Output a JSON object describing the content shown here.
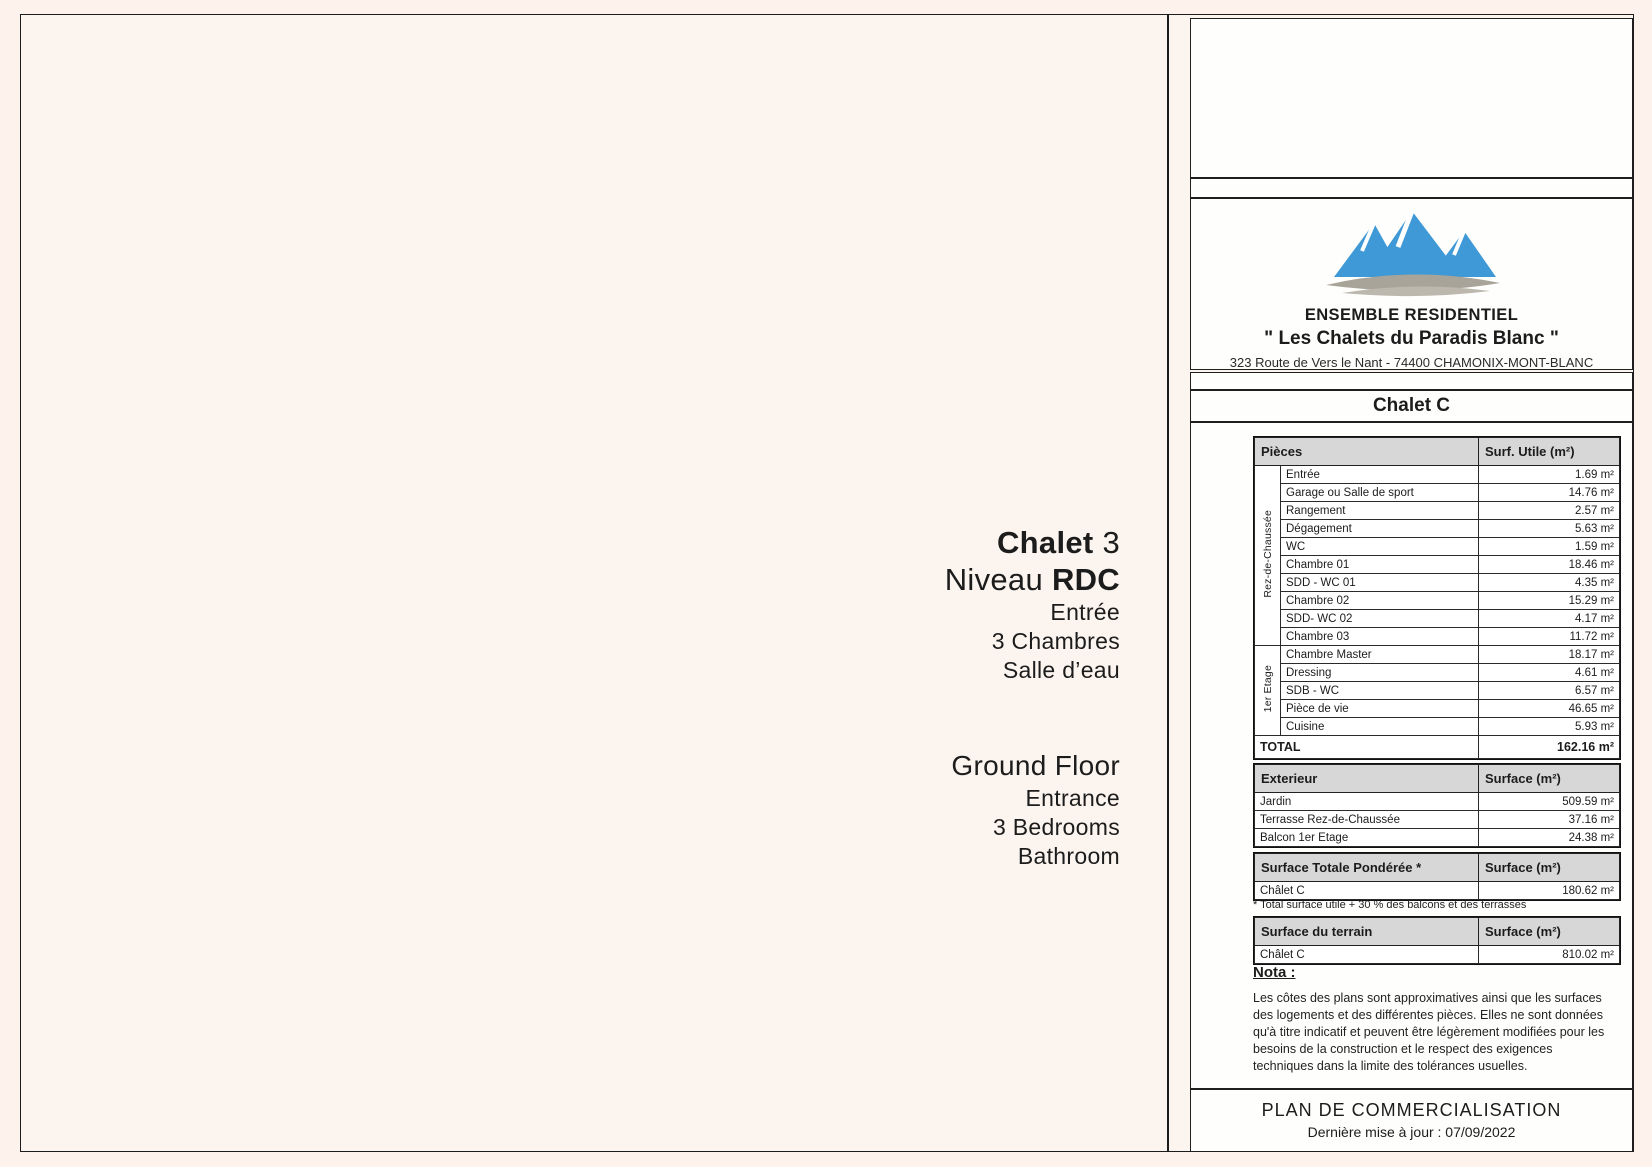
{
  "header": {
    "brand_line1": "ENSEMBLE RESIDENTIEL",
    "brand_line2": "\" Les Chalets du Paradis Blanc \"",
    "address": "323 Route de Vers le Nant - 74400 CHAMONIX-MONT-BLANC",
    "chalet_title": "Chalet C"
  },
  "plan_labels": {
    "fr": {
      "title_bold": "Chalet",
      "title_num": " 3",
      "level_plain": "Niveau ",
      "level_bold": "RDC",
      "lines": [
        "Entrée",
        "3 Chambres",
        "Salle d’eau"
      ]
    },
    "en": {
      "title": "Ground Floor",
      "lines": [
        "Entrance",
        "3 Bedrooms",
        "Bathroom"
      ]
    }
  },
  "compass": {
    "n": "N",
    "e": "E",
    "s": "S",
    "o": "O"
  },
  "surface_table": {
    "col1": "Pièces",
    "col2": "Surf. Utile (m²)",
    "groups": [
      {
        "label": "Rez-de-Chaussée",
        "rows": [
          [
            "Entrée",
            "1.69 m²"
          ],
          [
            "Garage ou Salle de sport",
            "14.76 m²"
          ],
          [
            "Rangement",
            "2.57 m²"
          ],
          [
            "Dégagement",
            "5.63 m²"
          ],
          [
            "WC",
            "1.59 m²"
          ],
          [
            "Chambre 01",
            "18.46 m²"
          ],
          [
            "SDD - WC 01",
            "4.35 m²"
          ],
          [
            "Chambre 02",
            "15.29 m²"
          ],
          [
            "SDD- WC 02",
            "4.17 m²"
          ],
          [
            "Chambre 03",
            "11.72 m²"
          ]
        ]
      },
      {
        "label": "1er Etage",
        "rows": [
          [
            "Chambre Master",
            "18.17 m²"
          ],
          [
            "Dressing",
            "4.61 m²"
          ],
          [
            "SDB - WC",
            "6.57 m²"
          ],
          [
            "Pièce de vie",
            "46.65 m²"
          ],
          [
            "Cuisine",
            "5.93 m²"
          ]
        ]
      }
    ],
    "total_label": "TOTAL",
    "total_value": "162.16 m²"
  },
  "exterior_table": {
    "col1": "Exterieur",
    "col2": "Surface (m²)",
    "rows": [
      [
        "Jardin",
        "509.59 m²"
      ],
      [
        "Terrasse Rez-de-Chaussée",
        "37.16 m²"
      ],
      [
        "Balcon 1er Etage",
        "24.38 m²"
      ]
    ]
  },
  "weighted_table": {
    "col1": "Surface Totale Pondérée *",
    "col2": "Surface (m²)",
    "rows": [
      [
        "Châlet C",
        "180.62 m²"
      ]
    ],
    "footnote": "* Total surface utile + 30 % des balcons et des terrasses"
  },
  "terrain_table": {
    "col1": "Surface du terrain",
    "col2": "Surface (m²)",
    "rows": [
      [
        "Châlet C",
        "810.02 m²"
      ]
    ]
  },
  "nota": {
    "heading": "Nota :",
    "text": "Les côtes des plans sont approximatives ainsi que les surfaces des logements et des différentes pièces. Elles ne sont données qu'à titre indicatif et peuvent être légèrement modifiées pour les besoins de la construction et le respect des exigences techniques dans la limite des tolérances usuelles."
  },
  "footer": {
    "title": "PLAN DE COMMERCIALISATION",
    "updated": "Dernière mise à jour : 07/09/2022"
  },
  "icons": {
    "logo": "mountain-logo",
    "compass": "compass-rose"
  },
  "colors": {
    "accent_blue": "#3f99d6",
    "slate_wall": "#51617c",
    "wood": "#b8894f",
    "deck": "#c2a098",
    "water": "#8ee8e2",
    "header_gray": "#d7d7d7"
  }
}
